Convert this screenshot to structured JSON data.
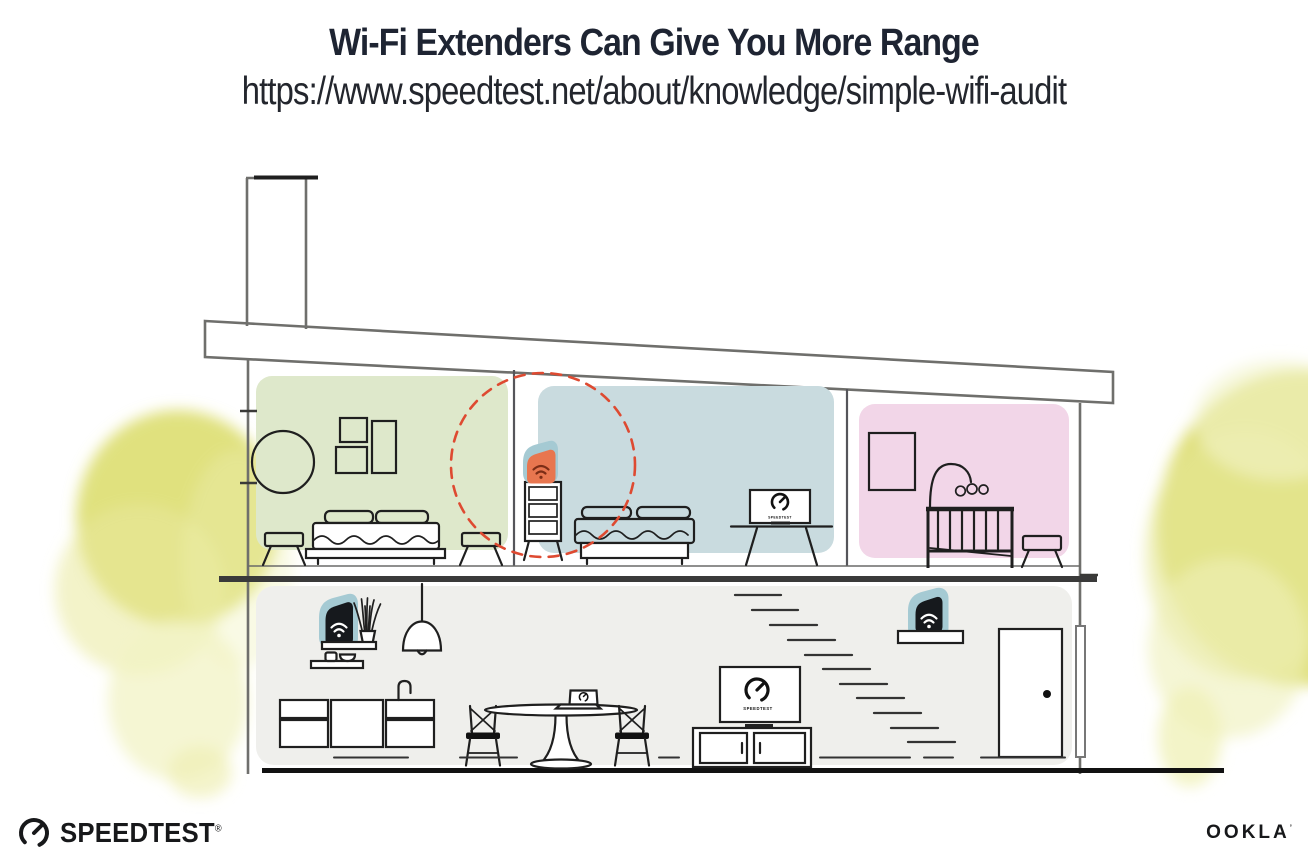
{
  "header": {
    "title": "Wi-Fi Extenders Can Give You More Range",
    "url": "https://www.speedtest.net/about/knowledge/simple-wifi-audit"
  },
  "illustration": {
    "bedroom_tv_label": "SPEEDTEST",
    "living_room_tv_label": "SPEEDTEST",
    "icons": {
      "wifi_extender_upstairs": "wifi-icon orange on teal badge (on bedroom dresser, inside dashed range circle)",
      "wifi_router_kitchen_shelf": "wifi-icon black on teal badge",
      "wifi_extender_stair_shelf": "wifi-icon black on teal badge",
      "tv_screens_and_laptop": "speedtest-gauge-icon"
    },
    "colors": {
      "accent_orange": "#e8764f",
      "accent_teal": "#a5cad3",
      "range_circle_red": "#de4a31",
      "bedroom_green": "#dee8cb",
      "bedroom_blue": "#c9dbdf",
      "nursery_pink": "#f2d6e8",
      "lower_floor_gray": "#efefec",
      "foliage_yellow": "#dbdc69",
      "structure_gray": "#6f6f6c",
      "ink": "#1f1f1f"
    }
  },
  "footer": {
    "speedtest_wordmark": "SPEEDTEST",
    "speedtest_trademark": "®",
    "ookla_wordmark": "OOKLA",
    "ookla_trademark": "’"
  }
}
